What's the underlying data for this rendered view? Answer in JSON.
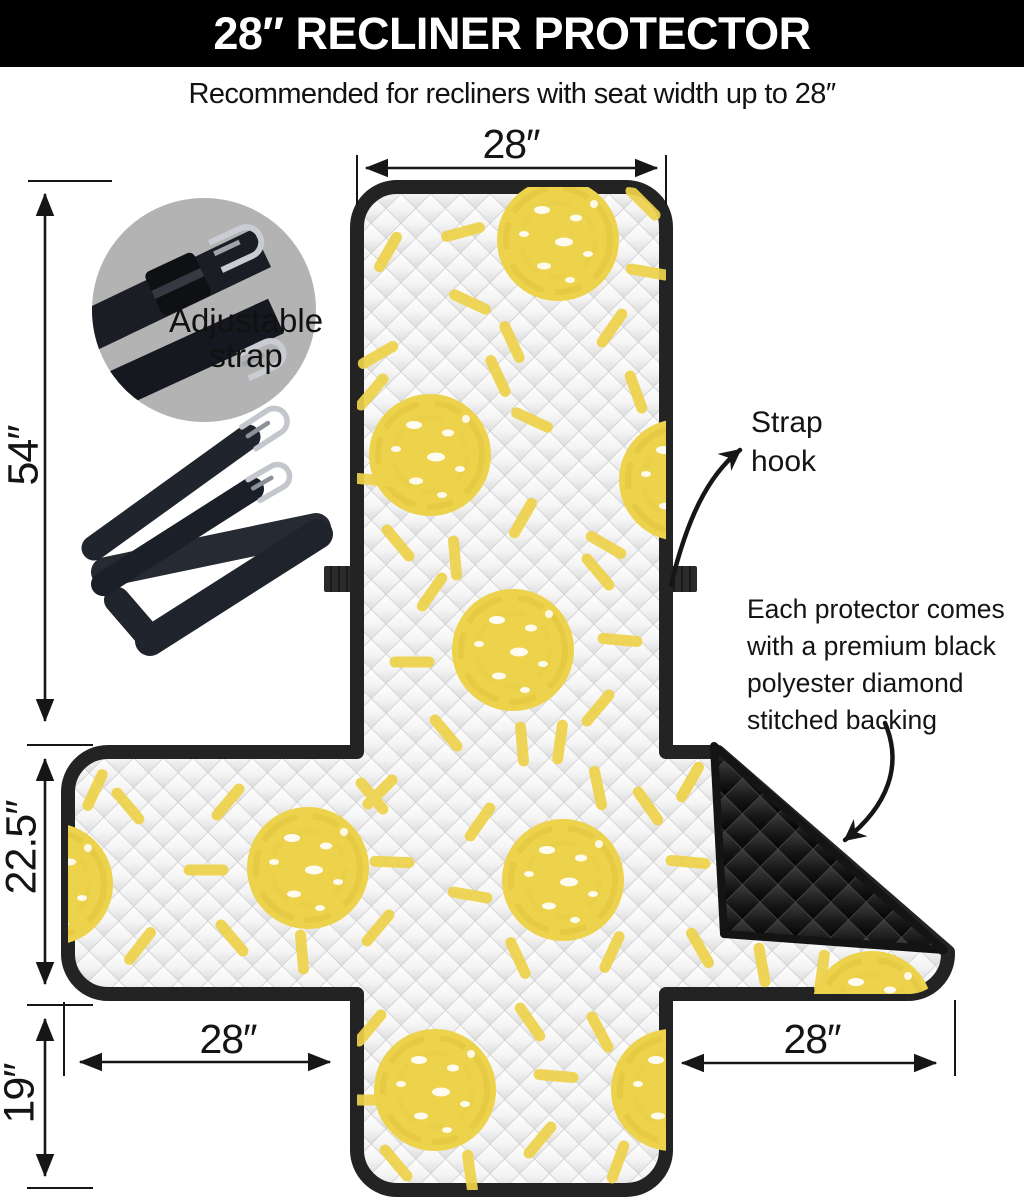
{
  "header": {
    "title": "28″ RECLINER PROTECTOR"
  },
  "subtitle": "Recommended for recliners with seat width up to 28″",
  "dimensions": {
    "top_width": "28″",
    "total_length": "54″",
    "seat_depth": "22.5″",
    "front_drop": "19″",
    "left_arm_width": "28″",
    "right_arm_width": "28″"
  },
  "callouts": {
    "adjustable_strap": {
      "line1": "Adjustable",
      "line2": "strap"
    },
    "strap_hook": {
      "line1": "Strap",
      "line2": "hook"
    },
    "backing_note": {
      "line1": "Each protector comes",
      "line2": "with a premium black",
      "line3": "polyester diamond",
      "line4": "stitched backing"
    }
  },
  "colors": {
    "header_bg": "#000000",
    "header_text": "#ffffff",
    "outline": "#232323",
    "sun_yellow": "#edd24c",
    "quilt_line": "#cccccc",
    "backing_black": "#181818",
    "inset_circle_gray": "#b3b3b3",
    "text": "#141414"
  }
}
